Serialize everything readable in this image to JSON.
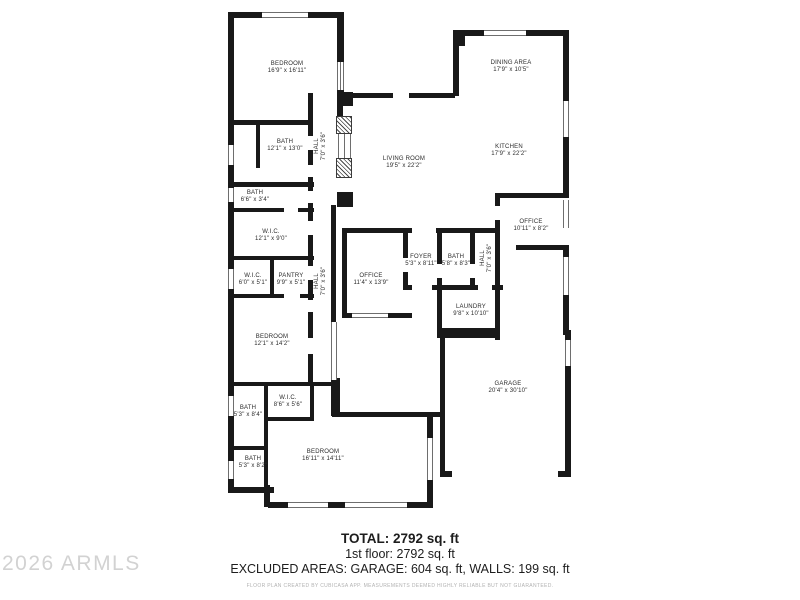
{
  "watermark": "2026 ARMLS",
  "summary": {
    "total": "TOTAL: 2792 sq. ft",
    "first_floor": "1st floor: 2792 sq. ft",
    "excluded": "EXCLUDED AREAS: GARAGE: 604 sq. ft, WALLS: 199 sq. ft",
    "disclaimer": "FLOOR PLAN CREATED BY CUBICASA APP. MEASUREMENTS DEEMED HIGHLY RELIABLE BUT NOT GUARANTEED."
  },
  "colors": {
    "wall": "#191919",
    "label_text": "#2b2b2b",
    "watermark_text": "#d2d2d2",
    "disclaimer_text": "#b2b2b2"
  },
  "rooms": [
    {
      "id": "bedroom-1",
      "name": "BEDROOM",
      "dims": "16'9\" x 16'11\""
    },
    {
      "id": "bath-1",
      "name": "BATH",
      "dims": "12'1\" x 13'0\""
    },
    {
      "id": "bath-2",
      "name": "BATH",
      "dims": "6'6\" x 3'4\""
    },
    {
      "id": "wic-1",
      "name": "W.I.C.",
      "dims": "12'1\" x 9'0\""
    },
    {
      "id": "wic-2",
      "name": "W.I.C.",
      "dims": "6'0\" x 5'1\""
    },
    {
      "id": "pantry",
      "name": "PANTRY",
      "dims": "9'9\" x 5'1\""
    },
    {
      "id": "bedroom-2",
      "name": "BEDROOM",
      "dims": "12'1\" x 14'2\""
    },
    {
      "id": "hall-1",
      "name": "HALL",
      "dims": "7'0\" x 3'6\""
    },
    {
      "id": "hall-2",
      "name": "HALL",
      "dims": "7'0\" x 3'6\""
    },
    {
      "id": "living-room",
      "name": "LIVING ROOM",
      "dims": "19'5\" x 22'2\""
    },
    {
      "id": "dining-area",
      "name": "DINING AREA",
      "dims": "17'9\" x 10'5\""
    },
    {
      "id": "kitchen",
      "name": "KITCHEN",
      "dims": "17'9\" x 22'2\""
    },
    {
      "id": "office-1",
      "name": "OFFICE",
      "dims": "10'11\" x 8'2\""
    },
    {
      "id": "office-2",
      "name": "OFFICE",
      "dims": "11'4\" x 13'9\""
    },
    {
      "id": "foyer",
      "name": "FOYER",
      "dims": "5'3\" x 8'11\""
    },
    {
      "id": "bath-3",
      "name": "BATH",
      "dims": "5'8\" x 8'3\""
    },
    {
      "id": "hall-3",
      "name": "HALL",
      "dims": "7'0\" x 3'6\""
    },
    {
      "id": "laundry",
      "name": "LAUNDRY",
      "dims": "9'8\" x 10'10\""
    },
    {
      "id": "garage",
      "name": "GARAGE",
      "dims": "20'4\" x 30'10\""
    },
    {
      "id": "bath-4",
      "name": "BATH",
      "dims": "5'3\" x 8'4\""
    },
    {
      "id": "wic-3",
      "name": "W.I.C.",
      "dims": "8'6\" x 5'6\""
    },
    {
      "id": "bath-5",
      "name": "BATH",
      "dims": "5'3\" x 8'2\""
    },
    {
      "id": "bedroom-3",
      "name": "BEDROOM",
      "dims": "16'11\" x 14'11\""
    }
  ]
}
